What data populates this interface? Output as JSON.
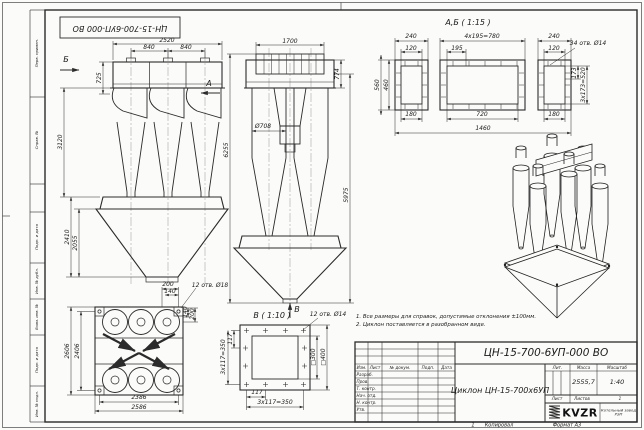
{
  "sheet": {
    "stamp": "ЦН-15-700-6УП-000 ВО",
    "margin_labels": [
      "Перв. примен.",
      "Справ. №",
      "Подп. и дата",
      "Инв. № дубл.",
      "Взам. инв. №",
      "Подп. и дата",
      "Инв. № подл."
    ],
    "copy_num": "1",
    "copied": "Копировал",
    "format": "Формат А3"
  },
  "notes": {
    "line1": "1. Все размеры для справок, допустимые отклонения ±100мм.",
    "line2": "2. Циклон поставляется в разобранном виде."
  },
  "front_view": {
    "arrow_a": "А",
    "arrow_b": "Б",
    "d2520": "2520",
    "d840a": "840",
    "d840b": "840",
    "d725": "725",
    "d3120": "3120",
    "d2410": "2410",
    "d2055": "2055"
  },
  "side_view": {
    "arrow_v": "В",
    "d1700": "1700",
    "d774": "774",
    "d708": "Ø708",
    "d6255": "6255",
    "d5975": "5975"
  },
  "section_ab": {
    "title": "А,Б ( 1:15 )",
    "holes": "34 отв. Ø14",
    "d240l": "240",
    "d120l": "120",
    "d780": "4х195=780",
    "d195": "195",
    "d240r": "240",
    "d120r": "120",
    "d560": "560",
    "d460": "460",
    "d180l": "180",
    "d720": "720",
    "d180r": "180",
    "d1460": "1460",
    "d173": "173",
    "d520": "3х173=520"
  },
  "plan_view": {
    "holes": "12 отв. Ø18",
    "d2606": "2606",
    "d2406": "2406",
    "d2386": "2386",
    "d2586": "2586",
    "d200t": "200",
    "d140t": "140",
    "d140r": "140",
    "d200r": "200"
  },
  "view_v": {
    "title": "В ( 1:10 )",
    "holes": "12 отв. Ø14",
    "d300": "□300",
    "d400": "□400",
    "d117b": "117",
    "d350b": "3х117=350",
    "d117l": "117",
    "d350l": "3х117=350"
  },
  "title_block": {
    "designation": "ЦН-15-700-6УП-000 ВО",
    "name": "Циклон ЦН-15-700х6УП",
    "h_izm": "Изм.",
    "h_list": "Лист",
    "h_doc": "№ докум.",
    "h_podp": "Подп.",
    "h_data": "Дата",
    "r1": "Разраб.",
    "r2": "Пров.",
    "r3": "Т. контр.",
    "r4": "Нач. отд.",
    "r5": "Н. контр.",
    "r6": "Утв.",
    "lit": "Лит.",
    "mass": "Масса",
    "scale": "Масштаб",
    "mass_value": "2555,7",
    "scale_value": "1:40",
    "list": "Лист",
    "listov": "Листов",
    "listov_value": "1",
    "logo": "KVZR",
    "logo_caption": "Котельный завод РЭП"
  }
}
